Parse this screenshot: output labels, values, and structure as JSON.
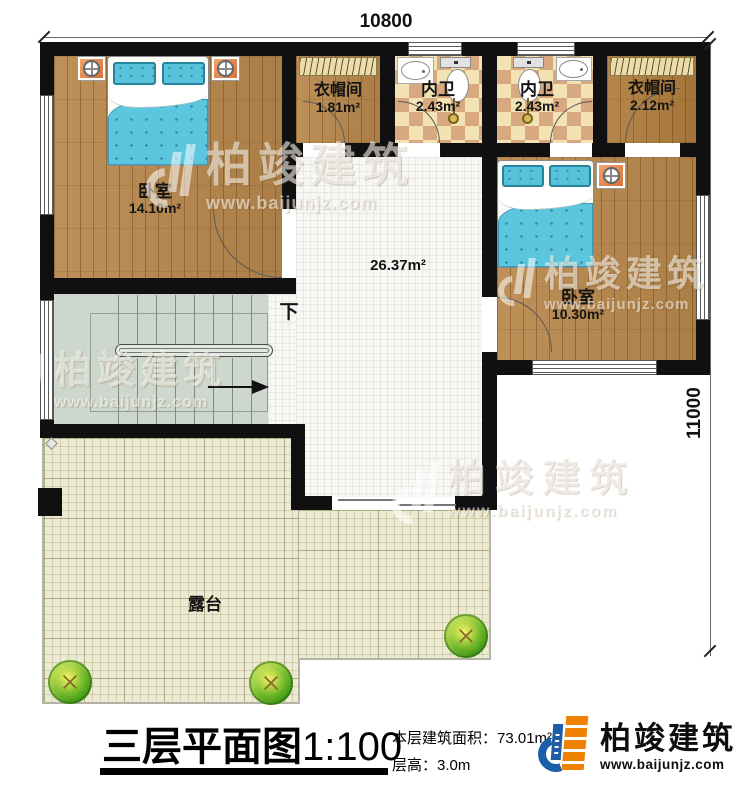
{
  "dimensions": {
    "width_mm": "10800",
    "height_mm": "11000"
  },
  "rooms": {
    "bedroom1": {
      "label": "卧室",
      "area": "14.10m²"
    },
    "cloakroom1": {
      "label": "衣帽间",
      "area": "1.81m²"
    },
    "bathroom1": {
      "label": "内卫",
      "area": "2.43m²"
    },
    "bathroom2": {
      "label": "内卫",
      "area": "2.43m²"
    },
    "cloakroom2": {
      "label": "衣帽间",
      "area": "2.12m²"
    },
    "bedroom2": {
      "label": "卧室",
      "area": "10.30m²"
    },
    "hall": {
      "area": "26.37m²"
    },
    "stairs": {
      "label": "下"
    },
    "terrace": {
      "label": "露台"
    }
  },
  "title_block": {
    "plan_title": "三层平面图",
    "plan_scale": "1:100",
    "floor_area_label": "本层建筑面积：",
    "floor_area_value": "73.01m²",
    "floor_height_label": "层高：",
    "floor_height_value": "3.0m"
  },
  "brand": {
    "name": "柏竣建筑",
    "website": "www.baijunjz.com"
  },
  "watermark": {
    "name": "柏竣建筑",
    "website": "www.baijunjz.com"
  },
  "colors": {
    "wall": "#101010",
    "wood_floor": "#b8884c",
    "checker_light": "#f3e2b4",
    "checker_dark": "#d8a87e",
    "terrace_tile": "#edead3",
    "stairs": "#cdd7cd",
    "bed_blue": "#5cc6de",
    "nightstand_orange": "#e78a50",
    "logo_blue": "#1c5fa8",
    "logo_orange": "#ef8200"
  }
}
